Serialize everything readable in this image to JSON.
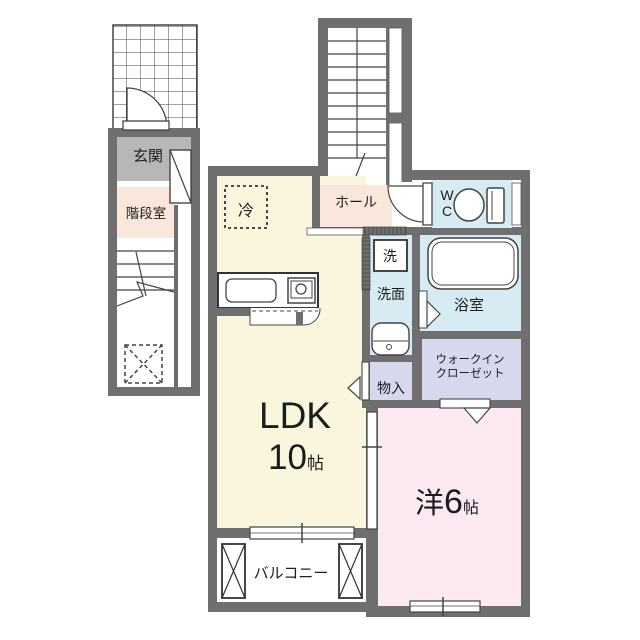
{
  "labels": {
    "entrance": "玄関",
    "stair_room": "階段室",
    "hall": "ホール",
    "wc_line1": "W",
    "wc_line2": "C",
    "bath": "浴室",
    "laundry": "洗",
    "washroom": "洗面",
    "storage": "物入",
    "wic_line1": "ウォークイン",
    "wic_line2": "クローゼット",
    "ldk": "LDK",
    "ldk_size": "10",
    "ldk_unit": "帖",
    "western": "洋",
    "western_size": "6",
    "western_unit": "帖",
    "balcony": "バルコニー",
    "refrigerator": "冷"
  },
  "colors": {
    "wall": "#6f6f6f",
    "line": "#333333",
    "ldk_floor": "#faf6de",
    "hall_floor": "#f9e7db",
    "western_floor": "#fce9f2",
    "wet_floor": "#d7ebf3",
    "closet_floor": "#d7d8ee",
    "entrance_floor": "#b7b7b7"
  }
}
